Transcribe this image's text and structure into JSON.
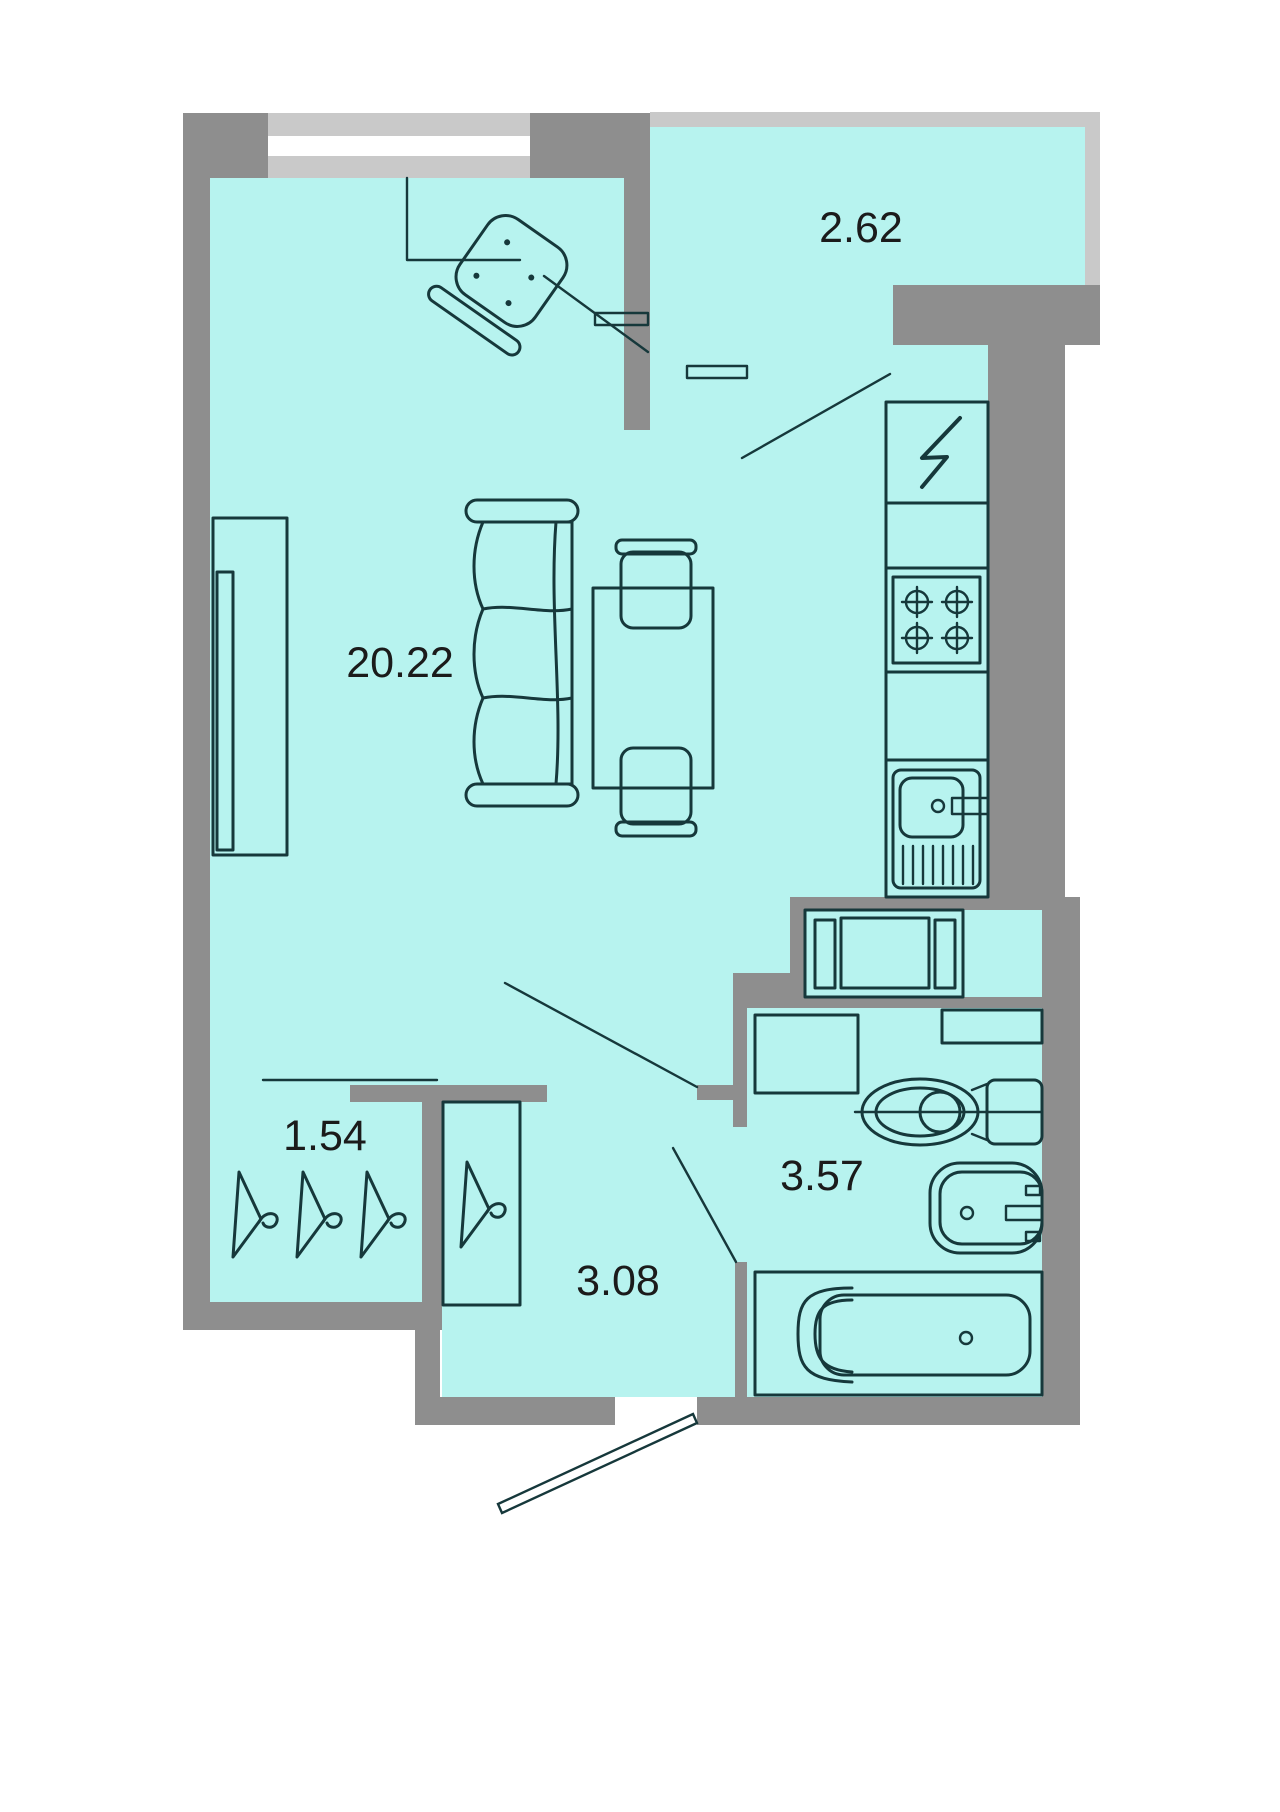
{
  "plan": {
    "type": "apartment-floor-plan",
    "rooms": [
      {
        "id": "living-room",
        "area_label": "20.22"
      },
      {
        "id": "balcony",
        "area_label": "2.62"
      },
      {
        "id": "closet",
        "area_label": "1.54"
      },
      {
        "id": "hallway",
        "area_label": "3.08"
      },
      {
        "id": "bathroom",
        "area_label": "3.57"
      }
    ],
    "fixtures": [
      "window",
      "balcony-rail",
      "electric-panel",
      "stove",
      "kitchen-sink",
      "washing-machine",
      "toilet",
      "wash-basin",
      "bathtub",
      "boiler-cabinet",
      "sofa",
      "dining-table",
      "chairs",
      "armchair",
      "tv-stand",
      "clothes-hangers",
      "entrance-door",
      "interior-doors"
    ]
  },
  "colors": {
    "wall": "#8e8e8e",
    "window": "#c9c9c9",
    "floor": "#b7f3ef",
    "line": "#16383b",
    "label": "#1b1b1b",
    "background": "#ffffff"
  }
}
